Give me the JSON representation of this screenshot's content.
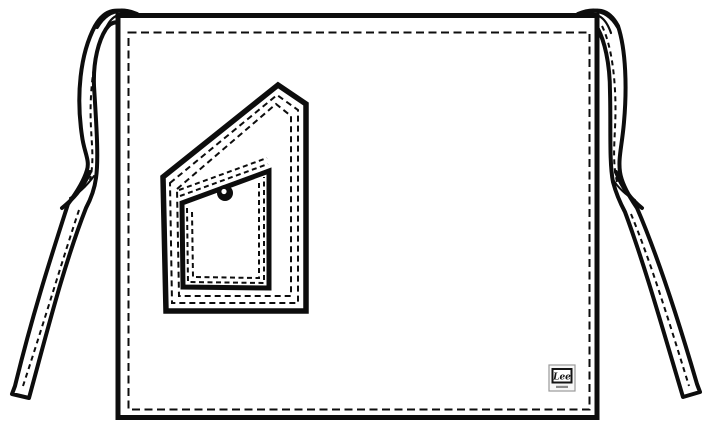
{
  "figure": {
    "subject": "Half waist apron flat line drawing with two side ties and a slanted utility pocket with riveted inner pocket",
    "style": "black and white technical garment sketch",
    "line_color": "#0d0d0d",
    "background_color": "#ffffff"
  },
  "brand_label": {
    "text": "Lee"
  }
}
